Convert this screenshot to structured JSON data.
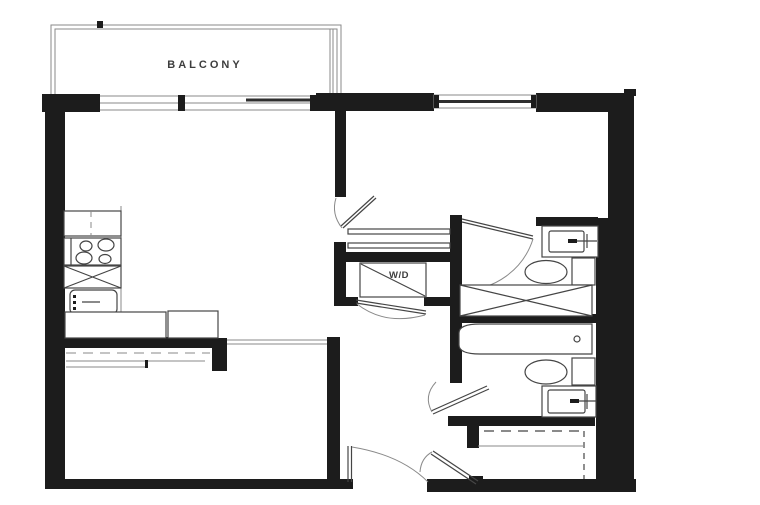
{
  "labels": {
    "balcony": "BALCONY",
    "washer_dryer": "W/D"
  },
  "colors": {
    "background": "#ffffff",
    "wall": "#1c1c1c",
    "line_dark": "#454545",
    "line_medium": "#8a8a8a",
    "text": "#3d3d3d"
  }
}
